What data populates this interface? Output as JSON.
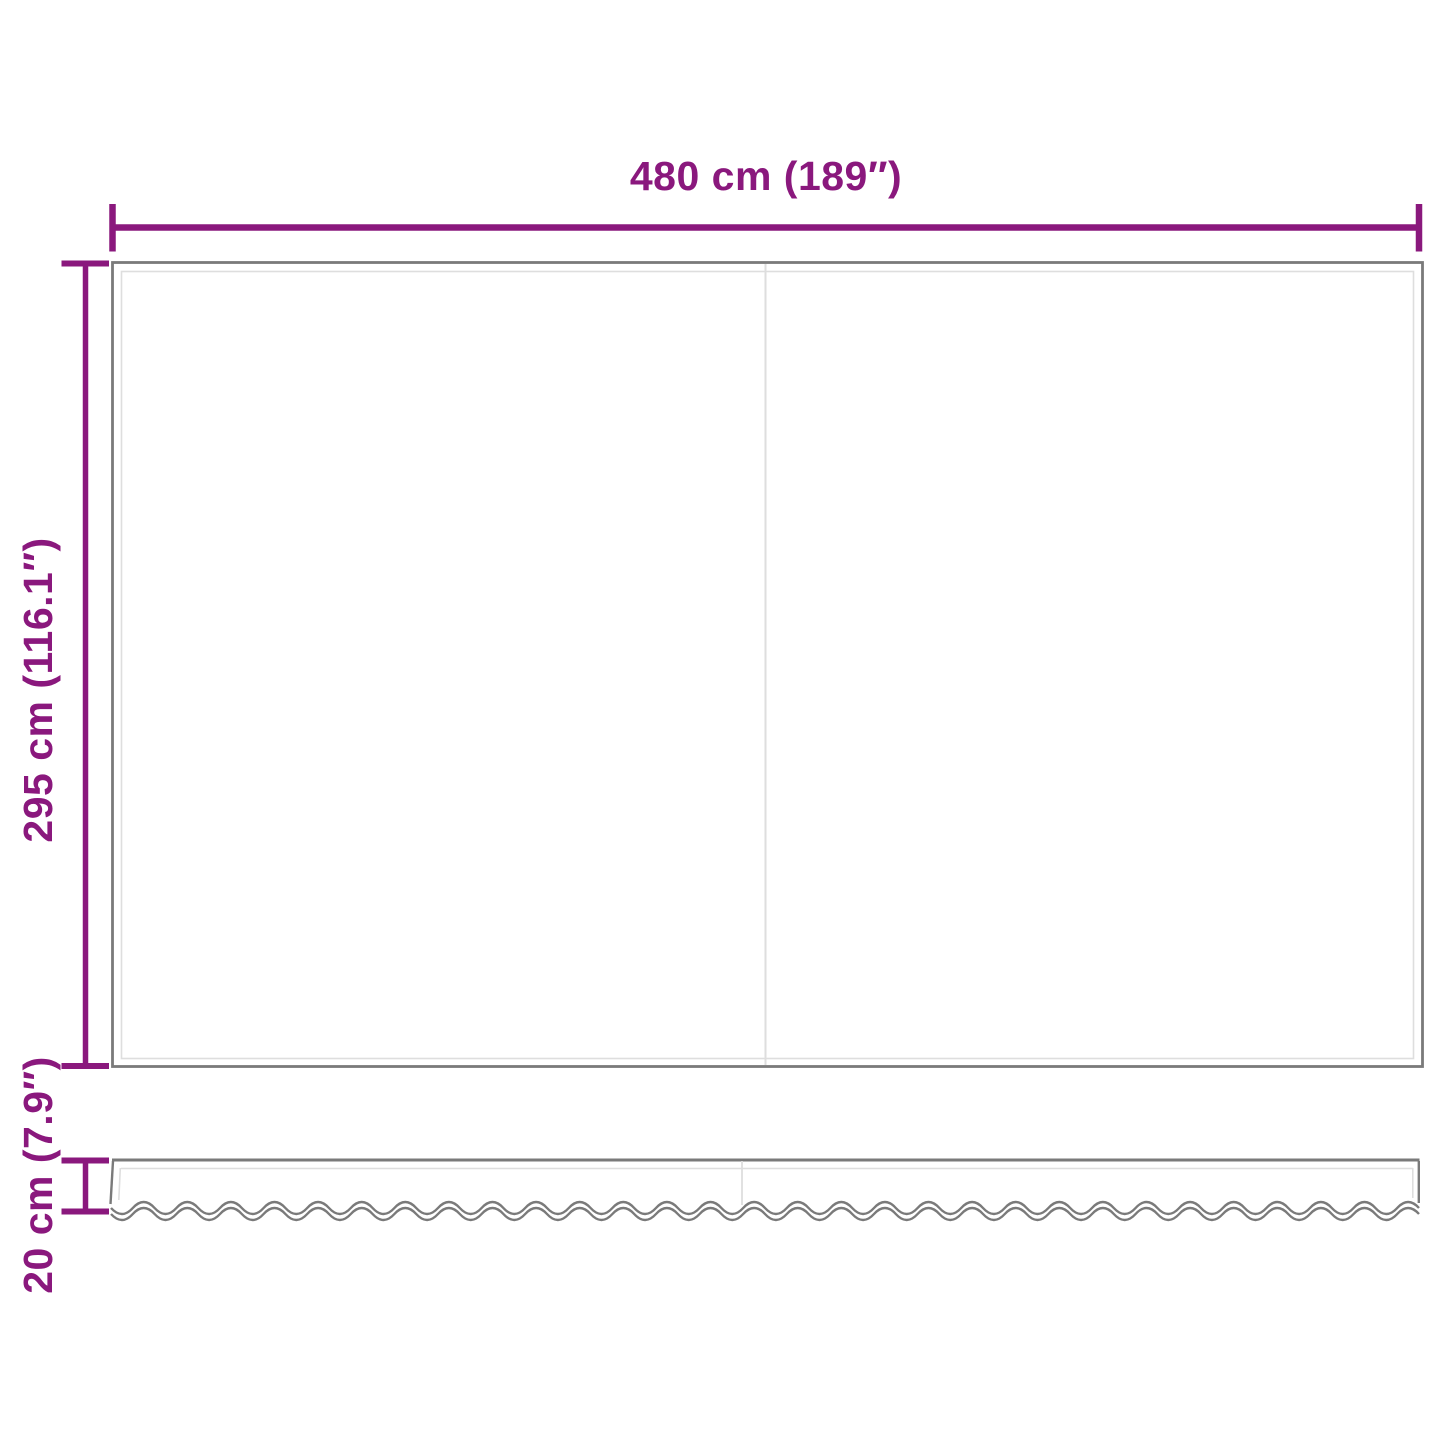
{
  "dimension_labels": {
    "width": "480 cm (189″)",
    "height": "295 cm (116.1″)",
    "valance_height": "20 cm (7.9″)"
  },
  "dimension_values": {
    "width_cm": 480,
    "width_in": 189,
    "height_cm": 295,
    "height_in": 116.1,
    "valance_height_cm": 20,
    "valance_height_in": 7.9
  },
  "colors": {
    "accent": "#8a187d",
    "outline_dark": "#7a7a7a",
    "outline_light": "#dedede",
    "background": "#ffffff"
  }
}
